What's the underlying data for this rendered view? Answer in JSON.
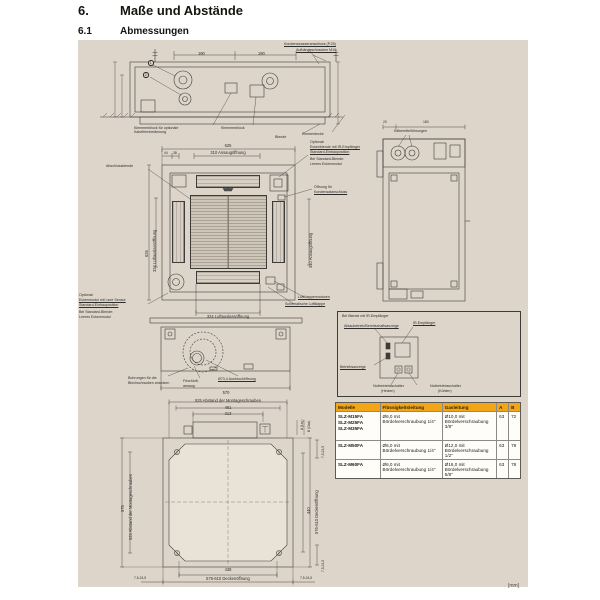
{
  "page": {
    "section_number": "6.",
    "section_title": "Maße und Abstände",
    "subsection_number": "6.1",
    "subsection_title": "Abmessungen",
    "unit_note": "[mm]"
  },
  "colors": {
    "panel_bg": "#ded5ca",
    "line": "#3d3c3a",
    "table_header_bg": "#f2a517"
  },
  "top_drawing": {
    "dim_190_left": "190",
    "dim_190_right": "190",
    "label_condensate": "Kondenswasseranschluss (P.25)",
    "label_bolts": "Aufhängeschrauben M10",
    "callout_1": "1",
    "callout_2": "2",
    "label_terminal_optional": "Klemmenblock für optionale Kabelfernbedienung",
    "label_terminal": "Klemmenblock",
    "label_panel": "Blende",
    "label_ceiling": "Zimmerdecke"
  },
  "front_view": {
    "dim_width": "625",
    "dim_intake_top": "310 Ansaugöffnung",
    "dim_44": "44",
    "dim_38": "38",
    "label_grille": "Abschlussblende",
    "dim_height": "625",
    "dim_outlet_left": "324 Luftauslassöffnung",
    "dim_intake_right": "310 Ansaugöffnung",
    "corner_ir_note_1": "Optional:",
    "corner_ir_note_2": "Eckenblende mit IR-Empfänger",
    "corner_ir_note_3": "Standard-Einbauposition",
    "corner_ir_note_4": "Bei Standard-Blende:",
    "corner_ir_note_5": "Leeres Eckenmodul",
    "label_drain_opening_1": "Öffnung für",
    "label_drain_opening_2": "Kondensatanschluss",
    "corner_isee_note_1": "Optional:",
    "corner_isee_note_2": "Eckenmodul mit i-see Sensor",
    "corner_isee_note_3": "Standard-Einbauposition",
    "corner_isee_note_4": "Bei Standard-Blende:",
    "corner_isee_note_5": "Leeres Eckenmodul",
    "label_vane_motors": "Luftklappenmotoren",
    "label_vane": "Schematische Luftklappe",
    "dim_outlet_bottom": "324 Luftauslassöffnung"
  },
  "side_view": {
    "label_pipes": "Kältemittelführungen",
    "dim_20": "20",
    "dim_180": "180"
  },
  "section_view": {
    "label_screw_holes_1": "Bohrungen für die",
    "label_screw_holes_2": "Blechschrauben ansetzen",
    "label_fresh_air_1": "Frischluft-",
    "label_fresh_air_2": "ansaug",
    "label_knockout": "Ø73,4 Ausbruchöffnung",
    "dim_570": "570"
  },
  "install_view": {
    "dim_mounting_top": "525 Abstand der Montageschrauben",
    "dim_461": "461",
    "dim_313": "313",
    "dim_575": "575",
    "dim_mounting_left": "525 Abstand der Montageschrauben",
    "dim_440": "440",
    "dim_ceiling_right": "576-610 Deckenöffnung",
    "label_a_liq": "A (Liq.)",
    "label_b_gas": "B (Gas)",
    "dim_corner_right_top": "7,5-24,5",
    "dim_corner_right_bottom": "7,5-24,5",
    "dim_438": "438",
    "dim_ceiling_bottom": "576-610 Deckenöffnung",
    "dim_corner_bottom_left": "7,5-24,5",
    "dim_corner_bottom_right": "7,5-24,5"
  },
  "ir_box": {
    "title": "Bei Blende mit IR-Empfänger",
    "label_defrost": "Abtaubetrieb/Bereitschaftsanzeige",
    "label_receiver": "IR-Empfänger",
    "label_operation": "Betriebsanzeige",
    "label_emergency_heat_1": "Notbetriebsschalter",
    "label_emergency_heat_2": "(Heizen)",
    "label_emergency_cool_1": "Notbetriebsschalter",
    "label_emergency_cool_2": "(Kühlen)"
  },
  "pipe_table": {
    "headers": [
      "Modelle",
      "Flüssigkeitsleitung",
      "Gasleitung",
      "A",
      "B"
    ],
    "rows": [
      {
        "models": [
          "SLZ-M15FA",
          "SLZ-M25FA",
          "SLZ-M35FA"
        ],
        "liquid": "Ø6,0 mit Bördelverschraubung 1/4\"",
        "gas": "Ø10,0 mit Bördelverschraubung 3/8\"",
        "a": "63",
        "b": "72"
      },
      {
        "models": [
          "SLZ-M50FA"
        ],
        "liquid": "Ø6,0 mit Bördelverschraubung 1/4\"",
        "gas": "Ø12,0 mit Bördelverschraubung 1/2\"",
        "a": "63",
        "b": "78"
      },
      {
        "models": [
          "SLZ-M60FA"
        ],
        "liquid": "Ø6,0 mit Bördelverschraubung 1/4\"",
        "gas": "Ø16,0 mit Bördelverschraubung 5/8\"",
        "a": "63",
        "b": "78"
      }
    ]
  }
}
